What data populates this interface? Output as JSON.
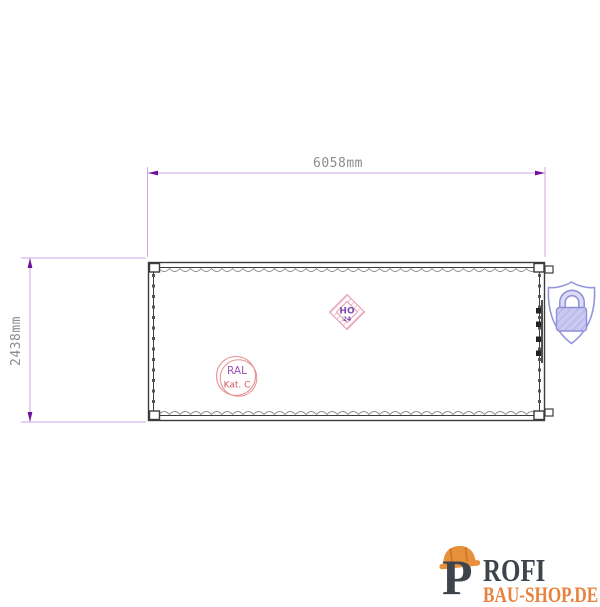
{
  "dimensions": {
    "width_label": "6058mm",
    "height_label": "2438mm"
  },
  "stamps": {
    "ral_line1": "RAL",
    "ral_line2": "Kat. C",
    "ho_line1": "HO",
    "ho_line2": "24"
  },
  "icons": {
    "security": "shield-lock-icon",
    "logo_helmet": "hard-hat-icon"
  },
  "logo": {
    "letter": "P",
    "word_rest": "ROFI",
    "line2": "BAU-SHOP.DE"
  },
  "colors": {
    "dimension_line": "#cfa6ea",
    "dimension_arrow": "#70119c",
    "dimension_text": "#8c8c8c",
    "drawing_line": "#3c3c3c",
    "corrugation_gray": "#8a8a8a",
    "stamp_ring_pink": "#e69090",
    "stamp_text_purple": "#9a52b8",
    "stamp_text_red": "#d05858",
    "diamond_pink": "#e49ab0",
    "shield_purple": "#9494dc",
    "lock_body_fill": "#c9c9f0",
    "logo_orange": "#e8893a",
    "logo_dark": "#3d444c"
  }
}
